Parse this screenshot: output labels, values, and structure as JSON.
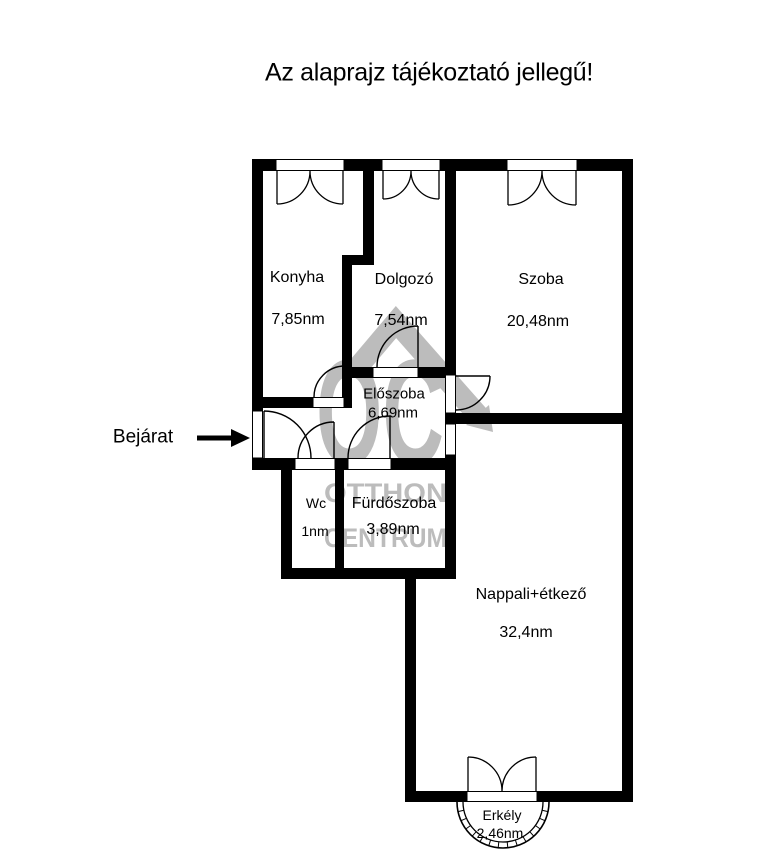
{
  "title": "Az alaprajz tájékoztató jellegű!",
  "entrance": {
    "label": "Bejárat"
  },
  "watermark": {
    "logo_text": "OC",
    "line1": "OTTHON",
    "line2": "CENTRUM",
    "color": "#bcbcbc"
  },
  "rooms": [
    {
      "name": "Konyha",
      "area": "7,85nm"
    },
    {
      "name": "Dolgozó",
      "area": "7,54nm"
    },
    {
      "name": "Szoba",
      "area": "20,48nm"
    },
    {
      "name": "Előszoba",
      "area": "6,69nm"
    },
    {
      "name": "Wc",
      "area": "1nm"
    },
    {
      "name": "Fürdőszoba",
      "area": "3,89nm"
    },
    {
      "name": "Nappali+étkező",
      "area": "32,4nm"
    },
    {
      "name": "Erkély",
      "area": "2,46nm"
    }
  ],
  "colors": {
    "walls": "#000000",
    "background": "#ffffff",
    "watermark": "#bcbcbc"
  }
}
